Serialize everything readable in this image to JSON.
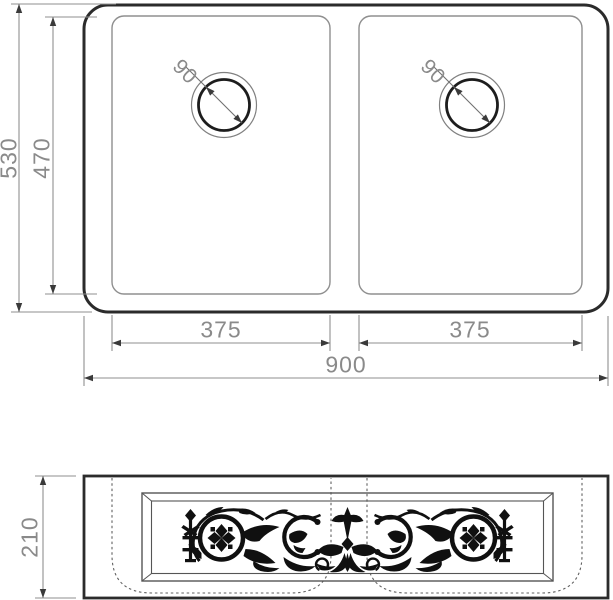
{
  "drawing_title": "double-bowl-sink-technical-drawing",
  "top_view": {
    "overall_width": "900",
    "overall_depth": "530",
    "inner_depth": "470",
    "left_bowl_width": "375",
    "right_bowl_width": "375",
    "left_drain_diameter": "90",
    "right_drain_diameter": "90"
  },
  "front_view": {
    "apron_height": "210"
  },
  "icons": {
    "ornament": "damask-scroll-ornament"
  },
  "colors": {
    "outline_dark": "#2b2b2b",
    "outline_light": "#8f8f8f",
    "dimension_line": "#8f8f8f",
    "arrow": "#3a3a3a",
    "dimension_text": "#8a8a8a",
    "ornament_black": "#101010",
    "background": "#ffffff"
  }
}
